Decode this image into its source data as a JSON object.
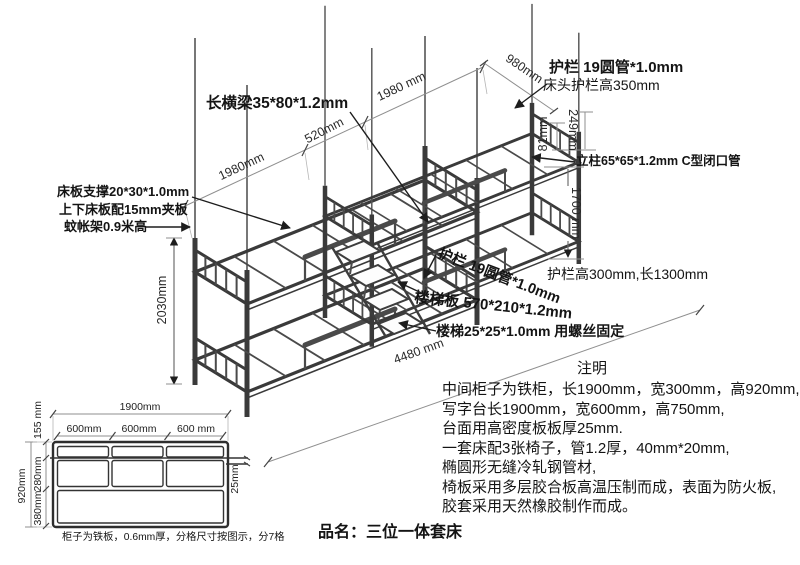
{
  "product": {
    "name_line": "品名：三位一体套床"
  },
  "bed_labels": {
    "long_beam": "长横梁35*80*1.2mm",
    "head_guardrail": "护栏 19圆管*1.0mm",
    "head_guardrail_height": "床头护栏高350mm",
    "pillar": "立柱65*65*1.2mm C型闭口管",
    "side_guardrail_size": "护栏高300mm,长1300mm",
    "mid_guardrail": "护栏 19圆管*1.0mm",
    "stair_board": "楼梯板 570*210*1.2mm",
    "stair_tube": "楼梯25*25*1.0mm 用螺丝固定",
    "slat_support": "床板支撑20*30*1.0mm",
    "slat_board": "上下床板配15mm夹板",
    "net_frame": "蚊帐架0.9米高"
  },
  "bed_dims": {
    "left_length": "1980mm",
    "overlap": "520mm",
    "right_length": "1980 mm",
    "head_width": "980mm",
    "rail_drop": "249mm",
    "rail_gap": "81mm",
    "pillar_height": "1700 mm",
    "total_height": "2030mm",
    "total_length": "4480 mm"
  },
  "cabinet": {
    "total_width": "1900mm",
    "cell_width_1": "600mm",
    "cell_width_2": "600mm",
    "cell_width_3": "600 mm",
    "top_row_height": "155 mm",
    "total_height": "920mm",
    "middle_row_height": "280mm",
    "bottom_row_height": "380mm",
    "desk_thickness": "25mm",
    "caption": "柜子为铁板，0.6mm厚，分格尺寸按图示，分7格"
  },
  "notes": {
    "heading": "注明",
    "lines": [
      "中间柜子为铁柜，长1900mm，宽300mm，高920mm,",
      "写字台长1900mm，宽600mm，高750mm,",
      "台面用高密度板板厚25mm.",
      "一套床配3张椅子，管1.2厚，40mm*20mm,",
      "椭圆形无缝冷轧钢管材,",
      "椅板采用多层胶合板高温压制而成，表面为防火板,",
      "胶套采用天然橡胶制作而成。"
    ]
  },
  "colors": {
    "line_art": "#3a3a3a",
    "dimension": "#8f8f8f",
    "text": "#141414",
    "background": "#ffffff"
  }
}
